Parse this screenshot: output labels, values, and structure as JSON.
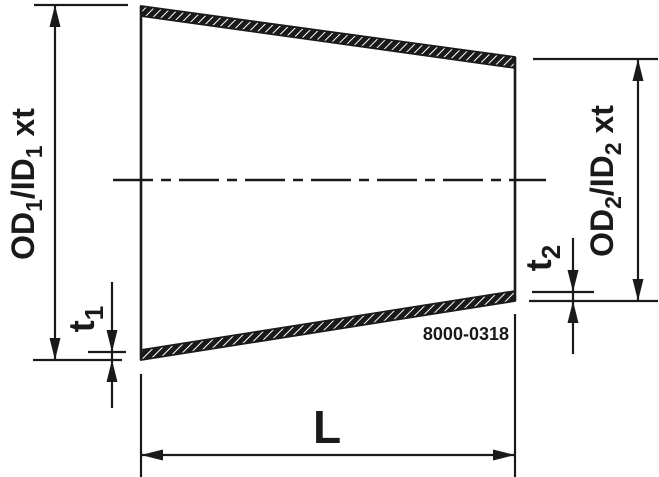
{
  "drawing": {
    "part_number": "8000-0318",
    "labels": {
      "left_diameter": {
        "p1": "OD",
        "s1": "1",
        "p2": "/ID",
        "s2": "1",
        "p3": " xt"
      },
      "right_diameter": {
        "p1": "OD",
        "s1": "2",
        "p2": "/ID",
        "s2": "2",
        "p3": " xt"
      },
      "wall_thickness_left": {
        "p1": "t",
        "s1": "1"
      },
      "wall_thickness_right": {
        "p1": "t",
        "s1": "2"
      },
      "length": "L"
    },
    "colors": {
      "line": "#1a1a1a",
      "background": "#ffffff"
    }
  }
}
